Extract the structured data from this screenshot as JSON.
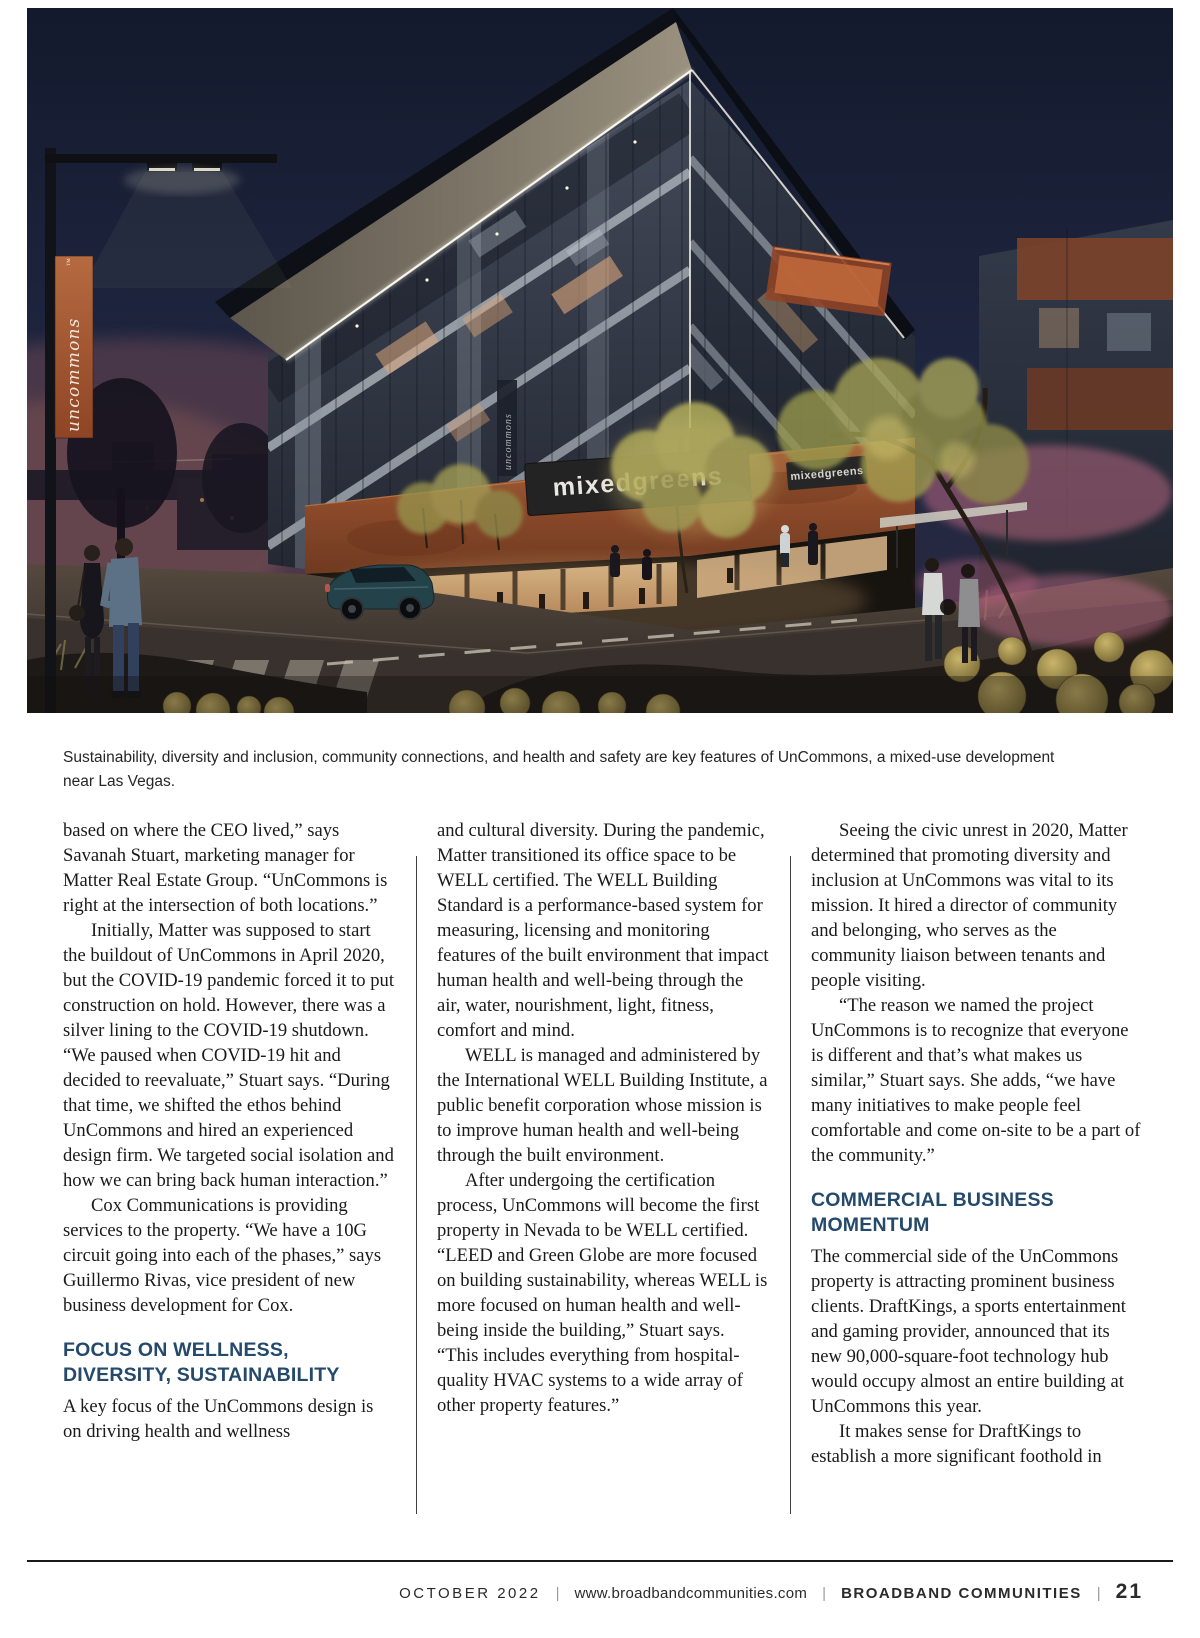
{
  "hero": {
    "banner_text": "uncommons",
    "banner_tm": "™",
    "column_text": "uncommons",
    "sign_primary": "mixedgreens",
    "sign_secondary": "mixedgreens"
  },
  "caption": "Sustainability, diversity and inclusion, community connections, and health and safety are key features of UnCommons, a mixed-use development near Las Vegas.",
  "article": {
    "columns": [
      {
        "blocks": [
          {
            "type": "paragraph",
            "text": "based on where the CEO lived,” says Savanah Stuart, marketing manager for Matter Real Estate Group. “UnCommons is right at the intersection of both locations.”"
          },
          {
            "type": "paragraph",
            "text": "Initially, Matter was supposed to start the buildout of UnCommons in April 2020, but the COVID-19 pandemic forced it to put construction on hold. However, there was a silver lining to the COVID-19 shutdown. “We paused when COVID-19 hit and decided to reevaluate,” Stuart says. “During that time, we shifted the ethos behind UnCommons and hired an experienced design firm. We targeted social isolation and how we can bring back human interaction.”"
          },
          {
            "type": "paragraph",
            "text": "Cox Communications is providing services to the property. “We have a 10G circuit going into each of the phases,” says Guillermo Rivas, vice president of new business development for Cox."
          },
          {
            "type": "heading",
            "text": "FOCUS ON WELLNESS, DIVERSITY, SUSTAINABILITY"
          },
          {
            "type": "paragraph",
            "text": "A key focus of the UnCommons design is on driving health and wellness"
          }
        ]
      },
      {
        "blocks": [
          {
            "type": "paragraph",
            "text": "and cultural diversity. During the pandemic, Matter transitioned its office space to be WELL certified. The WELL Building Standard is a performance-based system for measuring, licensing and monitoring features of the built environment that impact human health and well-being through the air, water, nourishment, light, fitness, comfort and mind."
          },
          {
            "type": "paragraph",
            "text": "WELL is managed and administered by the International WELL Building Institute, a public benefit corporation whose mission is to improve human health and well-being through the built environment."
          },
          {
            "type": "paragraph",
            "text": "After undergoing the certification process, UnCommons will become the first property in Nevada to be WELL certified. “LEED and Green Globe are more focused on building sustainability, whereas WELL is more focused on human health and well-being inside the building,” Stuart says. “This includes everything from hospital-quality HVAC systems to a wide array of other property features.”"
          }
        ]
      },
      {
        "blocks": [
          {
            "type": "paragraph",
            "text": "Seeing the civic unrest in 2020, Matter determined that promoting diversity and inclusion at UnCommons was vital to its mission. It hired a director of community and belonging, who serves as the community liaison between tenants and people visiting."
          },
          {
            "type": "paragraph",
            "text": "“The reason we named the project UnCommons is to recognize that everyone is different and that’s what makes us similar,” Stuart says. She adds, “we have many initiatives to make people feel comfortable and come on-site to be a part of the community.”"
          },
          {
            "type": "heading",
            "text": "COMMERCIAL BUSINESS MOMENTUM"
          },
          {
            "type": "paragraph",
            "text": "The commercial side of the UnCommons property is attracting prominent business clients. DraftKings, a sports entertainment and gaming provider, announced that its new 90,000-square-foot technology hub would occupy almost an entire building at UnCommons this year."
          },
          {
            "type": "paragraph",
            "text": "It makes sense for DraftKings to establish a more significant foothold in"
          }
        ]
      }
    ]
  },
  "footer": {
    "issue": "OCTOBER 2022",
    "separator": "|",
    "website": "www.broadbandcommunities.com",
    "publication": "BROADBAND COMMUNITIES",
    "page_number": "21"
  },
  "colors": {
    "heading": "#24496b",
    "banner_orange": "#b0613a",
    "copper_band": "#8c4a2a",
    "sky_navy": "#1b2138",
    "footer_rule": "#1a1a1a"
  }
}
